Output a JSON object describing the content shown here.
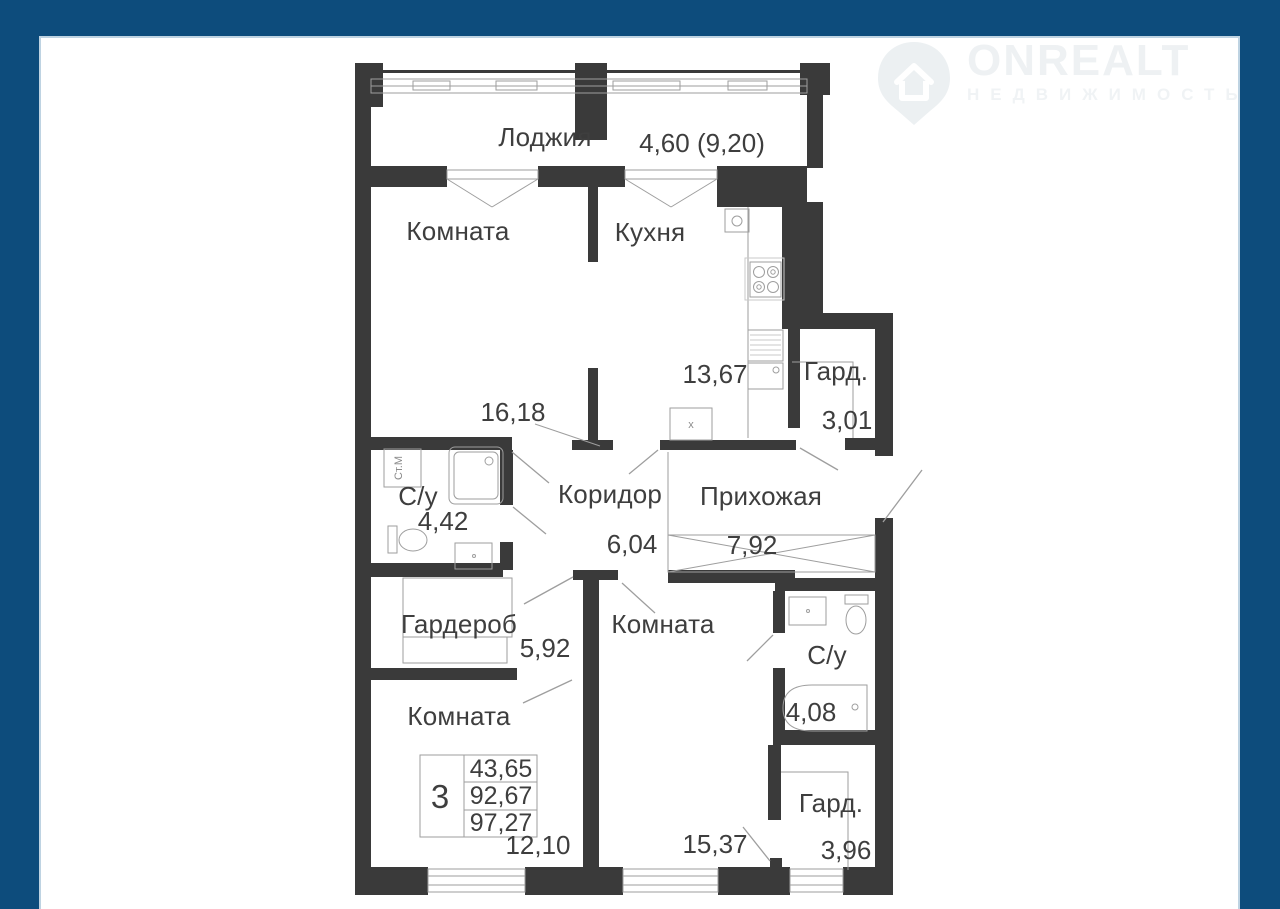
{
  "brand": {
    "name": "ONREALT",
    "subtitle": "НЕДВИЖИМОСТЬ"
  },
  "plan": {
    "stats": {
      "rooms": "3",
      "living_area": "43,65",
      "area": "92,67",
      "total_area": "97,27"
    },
    "rooms": [
      {
        "id": "loggia",
        "label": "Лоджия",
        "area": "4,60 (9,20)"
      },
      {
        "id": "room-top-left",
        "label": "Комната",
        "area": "16,18"
      },
      {
        "id": "kitchen",
        "label": "Кухня",
        "area": "13,67"
      },
      {
        "id": "wardrobe-top",
        "label": "Гард.",
        "area": "3,01"
      },
      {
        "id": "bathroom-left",
        "label": "С/у",
        "area": "4,42"
      },
      {
        "id": "corridor",
        "label": "Коридор",
        "area": "6,04"
      },
      {
        "id": "hallway",
        "label": "Прихожая",
        "area": "7,92"
      },
      {
        "id": "wardrobe-middle",
        "label": "Гардероб",
        "area": "5,92"
      },
      {
        "id": "room-middle",
        "label": "Комната",
        "area": "15,37"
      },
      {
        "id": "bathroom-right",
        "label": "С/у",
        "area": "4,08"
      },
      {
        "id": "room-bottom-left",
        "label": "Комната",
        "area": "12,10"
      },
      {
        "id": "wardrobe-bottom",
        "label": "Гард.",
        "area": "3,96"
      }
    ],
    "fixtures": {
      "washing_machine": "Ст.М",
      "vent": "x"
    }
  },
  "colors": {
    "frame": "#0d4c7c",
    "wall": "#3a3a3a",
    "thin_line": "#9e9e9e",
    "watermark": "#eef1f3",
    "background": "#ffffff"
  }
}
